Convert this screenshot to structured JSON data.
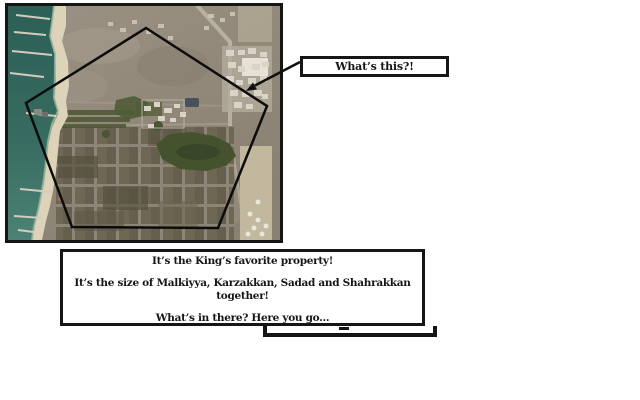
{
  "callout": {
    "text": "What’s this?!"
  },
  "infobox": {
    "lines": [
      "It’s the King’s favorite property!",
      "It’s the size of Malkiyya, Karzakkan, Sadad and Shahrakkan together!",
      "What’s in there? Here you go..."
    ]
  },
  "map": {
    "kind": "satellite aerial photo of a coastal area with a pentagon outline drawn over it"
  },
  "colors": {
    "ink": "#141414",
    "sea": "#33695f",
    "sand": "#ddd3b8",
    "land": "#948a7c",
    "vegetation": "#45522e",
    "farmland": "#6e6754",
    "urban": "#d9d4c7",
    "background": "#ffffff"
  }
}
